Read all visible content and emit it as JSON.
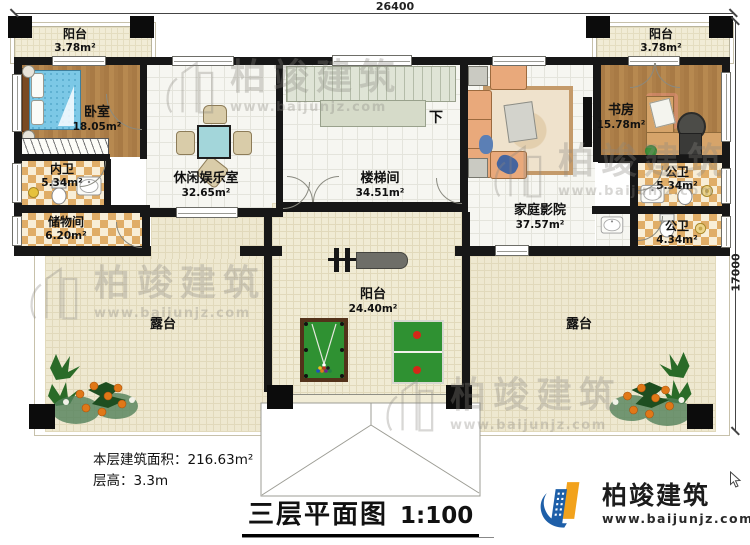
{
  "dimensions": {
    "top": "26400",
    "right": "17000"
  },
  "rooms": {
    "balcony_tl": {
      "name": "阳台",
      "area": "3.78m²"
    },
    "bedroom": {
      "name": "卧室",
      "area": "18.05m²"
    },
    "inner_bath": {
      "name": "内卫",
      "area": "5.34m²"
    },
    "storage": {
      "name": "储物间",
      "area": "6.20m²"
    },
    "leisure": {
      "name": "休闲娱乐室",
      "area": "32.65m²"
    },
    "stairwell": {
      "name": "楼梯间",
      "area": "34.51m²"
    },
    "home_theater": {
      "name": "家庭影院",
      "area": "37.57m²"
    },
    "study": {
      "name": "书房",
      "area": "15.78m²"
    },
    "balcony_tr": {
      "name": "阳台",
      "area": "3.78m²"
    },
    "public_bath_1": {
      "name": "公卫",
      "area": "5.34m²"
    },
    "public_bath_2": {
      "name": "公卫",
      "area": "4.34m²"
    },
    "balcony_main": {
      "name": "阳台",
      "area": "24.40m²"
    },
    "terrace_left": {
      "name": "露台"
    },
    "terrace_right": {
      "name": "露台"
    }
  },
  "stairs": {
    "direction_label": "下"
  },
  "footer": {
    "area_label": "本层建筑面积：",
    "area_value": "216.63m²",
    "floor_height_label": "层高：",
    "floor_height_value": "3.3m",
    "title": "三层平面图",
    "scale": "1:100"
  },
  "brand": {
    "name": "柏竣建筑",
    "website": "www.baijunjz.com",
    "blue": "#1e5fa8",
    "orange": "#f2a21c"
  },
  "watermark": {
    "name": "柏竣建筑",
    "website": "www.baijunjz.com"
  }
}
